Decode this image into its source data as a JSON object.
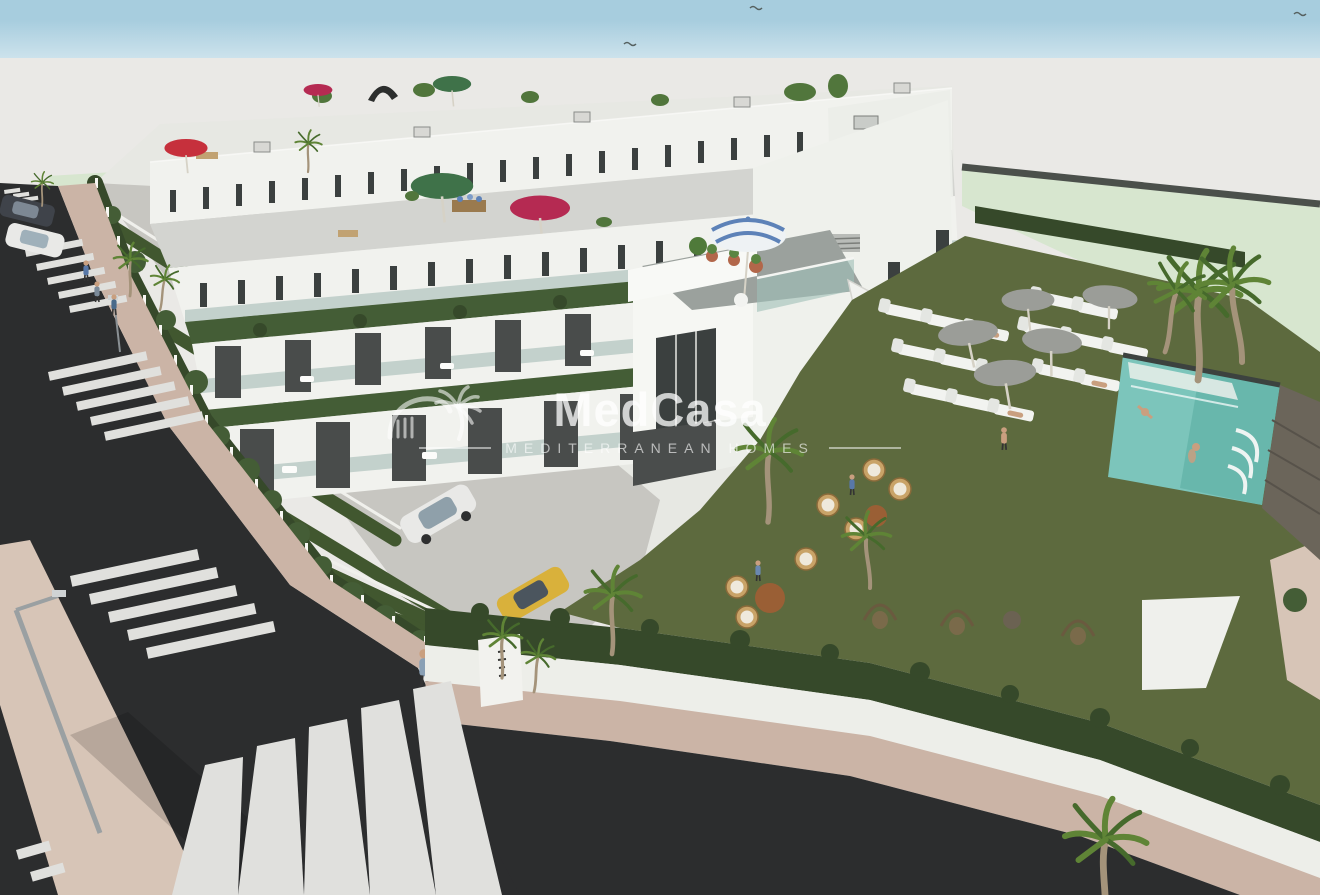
{
  "watermark": {
    "brand": "MedCasa",
    "tagline": "MEDITERRANEAN HOMES",
    "icon": "house-palm-logo",
    "color": "#ffffff"
  },
  "palette": {
    "sky": "#a7cdde",
    "backdrop": "#eae9e6",
    "mint": "#d7e6cf",
    "mint_wall": "#4b504b",
    "block": "#e7e8e3",
    "white_sun": "#f1f2ee",
    "terrace": "#d3d4d0",
    "hedge": "#445d36",
    "hedge_dark": "#36492a",
    "lawn": "#5d6a3e",
    "road": "#2c2d2e",
    "sidewalk": "#cbb4a6",
    "sidewalk_light": "#d7c5b7",
    "crosswalk": "#e0e0dd",
    "wall_white": "#edeee9",
    "pool_water": "#7cc5bb",
    "pool_deep": "#58aca1",
    "stone_wall": "#6b655a",
    "parasol_gray": "#9b9d98",
    "parasol_red": "#c6303c",
    "parasol_crimson": "#b52a52",
    "parasol_green": "#3f7249",
    "parasol_blue": "#5d82b8",
    "palm_green": "#5f8436",
    "terracotta": "#b2674a",
    "rattan": "#c9a368",
    "car_white": "#e9e9e7",
    "car_dark": "#3f434a",
    "car_yellow": "#d9b13b"
  }
}
